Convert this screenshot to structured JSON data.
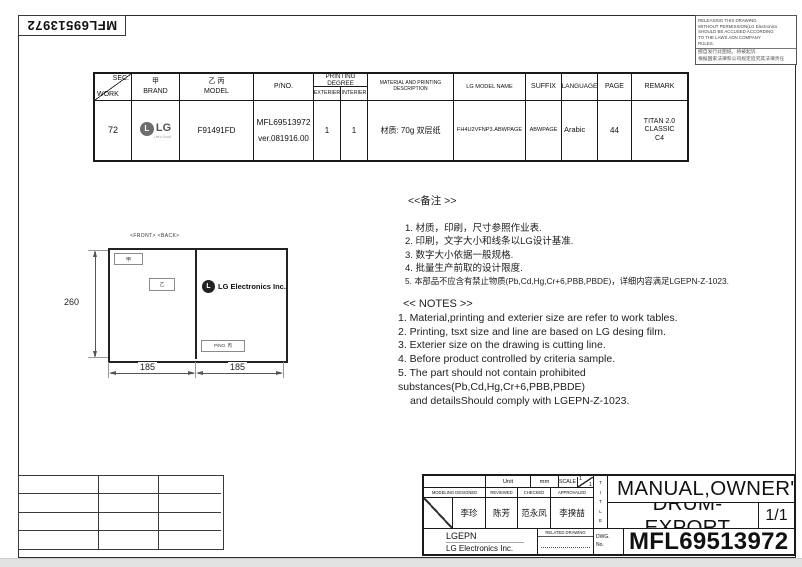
{
  "page": {
    "rotated_pno": "MFL69513972"
  },
  "warning": {
    "en_lines": [
      "RELEASING THIS DRAWING",
      "WITHOUT PERMISSION(LG Electronics",
      "SHOULD BE ACCUSED ACCORDING",
      "TO THE LAWS ADN COMPANY",
      "RULES."
    ],
    "cn_lines": [
      "擅自发行此图纸，将被起诉.",
      "根据国家法律和公司规定追究其法律责任"
    ]
  },
  "spec_table": {
    "headers": {
      "sec": "SEC.",
      "work": "WORK",
      "brand_cn": "甲",
      "brand": "BRAND",
      "model_cn": "乙 丙",
      "model": "MODEL",
      "pno": "P/NO.",
      "printing_degree": "PRINTING DEGREE",
      "exterier": "EXTERIER",
      "interier": "INTERIER",
      "material": "MATERIAL AND PRINTING DESCRIPTION",
      "lg_model_name": "LG MODEL NAME",
      "suffix": "SUFFIX",
      "language": "LANGUAGE",
      "page": "PAGE",
      "remark": "REMARK"
    },
    "row": {
      "work": "72",
      "brand": "LG",
      "brand_monogram": "L",
      "brand_tagline": "Life's Good",
      "model": "F91491FD",
      "pno": "MFL69513972",
      "pno_ver": "ver.081916.00",
      "exterier": "1",
      "interier": "1",
      "material": "材质: 70g 双层纸",
      "lg_model_name": "FH4U2VFNP3.ABWPAGE",
      "suffix": "ABWPAGE",
      "language": "Arabic",
      "page": "44",
      "remark_line1": "TITAN 2.0 CLASSIC",
      "remark_line2": "C4"
    }
  },
  "diagram": {
    "front_back": "<FRONT> <BACK>",
    "jia": "甲",
    "yi": "乙",
    "logo_monogram": "L",
    "logo_text": "LG Electronics Inc.",
    "pno_box": "P/NO. 丙",
    "dim_height": "260",
    "dim_left": "185",
    "dim_right": "185"
  },
  "notes_cn": {
    "title": "<<备注 >>",
    "items": [
      "1.  材质，印刷，尺寸参照作业表.",
      "2.  印刷，文字大小和线条以LG设计基准.",
      "3.  数字大小依据一般规格.",
      "4.  批量生产前取的设计限度.",
      "5.  本部品不应含有禁止物质(Pb,Cd,Hg,Cr+6,PBB,PBDE)，详细内容满足LGEPN-Z-1023."
    ]
  },
  "notes_en": {
    "title": "<< NOTES >>",
    "items": [
      "1. Material,printing and exterier size are refer to work tables.",
      "2. Printing, tsxt  size and line are based on LG desing film.",
      "3. Exterier size on the drawing is cutting line.",
      "4. Before product controlled by criteria sample.",
      "5. The part should not contain prohibited substances(Pb,Cd,Hg,Cr+6,PBB,PBDE)",
      "and detailsShould comply with LGEPN-Z-1023."
    ]
  },
  "title_block": {
    "unit_label": "Unit",
    "unit_value": "mm",
    "scale_label": "SCALE",
    "scale_top": "1",
    "scale_bottom": "1",
    "col_modeling": "MODELING DESIGNED",
    "col_reviewed": "REVIEWED",
    "col_checked": "CHECKED",
    "col_approvaled": "APPROVALED",
    "name_designed": "李珍",
    "name_reviewed": "陈芳",
    "name_checked": "范永凤",
    "name_approvaled": "李揆喆",
    "company_short": "LGEPN",
    "company_full": "LG Electronics Inc.",
    "related_drawing": "RELATED DRAWING",
    "title_vertical": "T\nI\nT\nL\nE",
    "dwg_label": "DWG.\nNo.",
    "title_line1": "MANUAL,OWNER'S",
    "title_line2": "DRUM-EXPORT",
    "sheet": "1/1",
    "dwg_no": "MFL69513972"
  }
}
